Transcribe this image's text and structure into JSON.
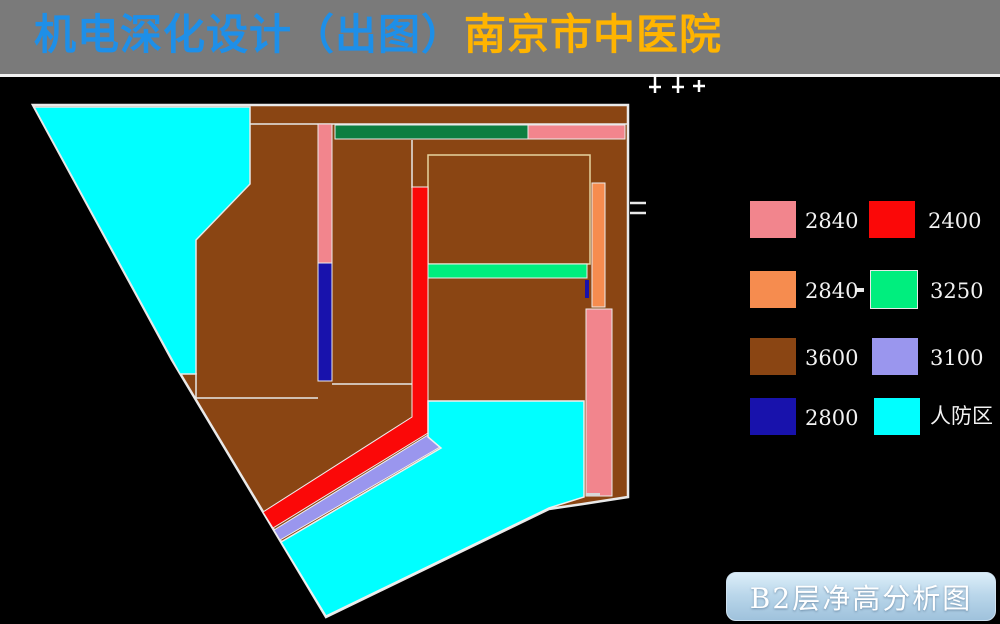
{
  "header": {
    "title_design": "机电深化设计（出图）",
    "title_hospital": "南京市中医院"
  },
  "colors": {
    "header_bar": "#7A7A7A",
    "title_design_color": "#1E8FE8",
    "title_hospital_color": "#FFB400",
    "outline": "#E9E9E9",
    "line": "#E8E8E8",
    "room_line": "#E6D3A0",
    "pink": "#F2858D",
    "red": "#FB0808",
    "orange": "#F68C4F",
    "spring_green": "#00EE7E",
    "brown": "#8A4513",
    "periwinkle": "#9A96EE",
    "navy": "#1812AC",
    "cyan": "#00FFFF",
    "dark_green": "#0C7E40"
  },
  "legend": {
    "rows": [
      {
        "left_label": "2840",
        "right_label": "2400"
      },
      {
        "left_label": "2840",
        "separator": "-",
        "right_label": "3250"
      },
      {
        "left_label": "3600",
        "right_label": "3100"
      },
      {
        "left_label": "2800",
        "right_label": "人防区"
      }
    ]
  },
  "footer": {
    "caption": "B2层净高分析图"
  }
}
